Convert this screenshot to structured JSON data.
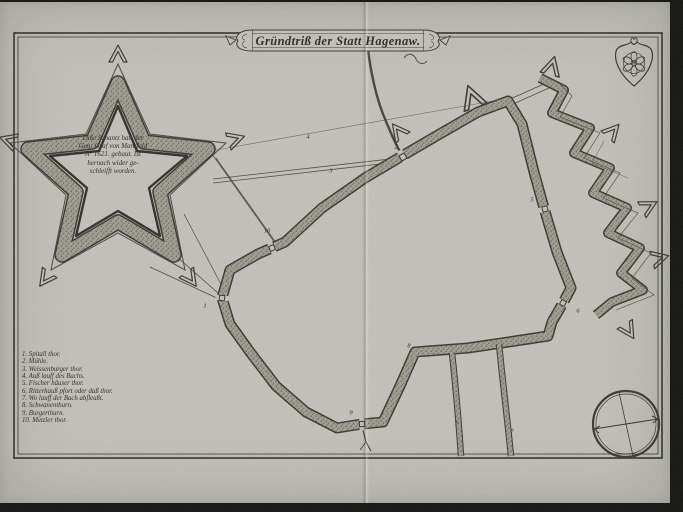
{
  "colors": {
    "paper": "#c6c5c0",
    "ink": "#3b3a34",
    "rampart_fill": "#a29f95",
    "photo_background": "#131312"
  },
  "banner": {
    "title": "Gründtriß der Statt Hagenaw."
  },
  "fort_note": {
    "lines": [
      "Diße Schantz hatt der",
      "Gen: Graf von Mansfeld",
      "A° 1621. gebaut. Ist",
      "hernach wider ge-",
      "schleifft worden."
    ]
  },
  "legend": {
    "items": [
      "1. Spitall thor.",
      "2. Mühle.",
      "3. Weissenburger thor.",
      "4. Auß lauff des Bachs.",
      "5. Fischer häuser thor.",
      "6. Ritterhauß pfort oder daß thor.",
      "7. Wo lauff der Bach abfleußt.",
      "8. Schwanenthurn.",
      "9. Burgerthurn.",
      "10. Metzler thor."
    ]
  },
  "map": {
    "markers": [
      {
        "n": "1",
        "x": 205,
        "y": 306
      },
      {
        "n": "2",
        "x": 396,
        "y": 147
      },
      {
        "n": "3",
        "x": 331,
        "y": 171
      },
      {
        "n": "4",
        "x": 308,
        "y": 137
      },
      {
        "n": "5",
        "x": 532,
        "y": 200
      },
      {
        "n": "6",
        "x": 578,
        "y": 311
      },
      {
        "n": "7",
        "x": 456,
        "y": 424
      },
      {
        "n": "7",
        "x": 512,
        "y": 432
      },
      {
        "n": "8",
        "x": 409,
        "y": 346
      },
      {
        "n": "9",
        "x": 351,
        "y": 413
      },
      {
        "n": "10",
        "x": 267,
        "y": 231
      }
    ]
  },
  "icons": {
    "coat_of_arms": "rose-shield-icon",
    "compass": "compass-rose-icon",
    "outworks": "ravelin-arrow-icon"
  }
}
